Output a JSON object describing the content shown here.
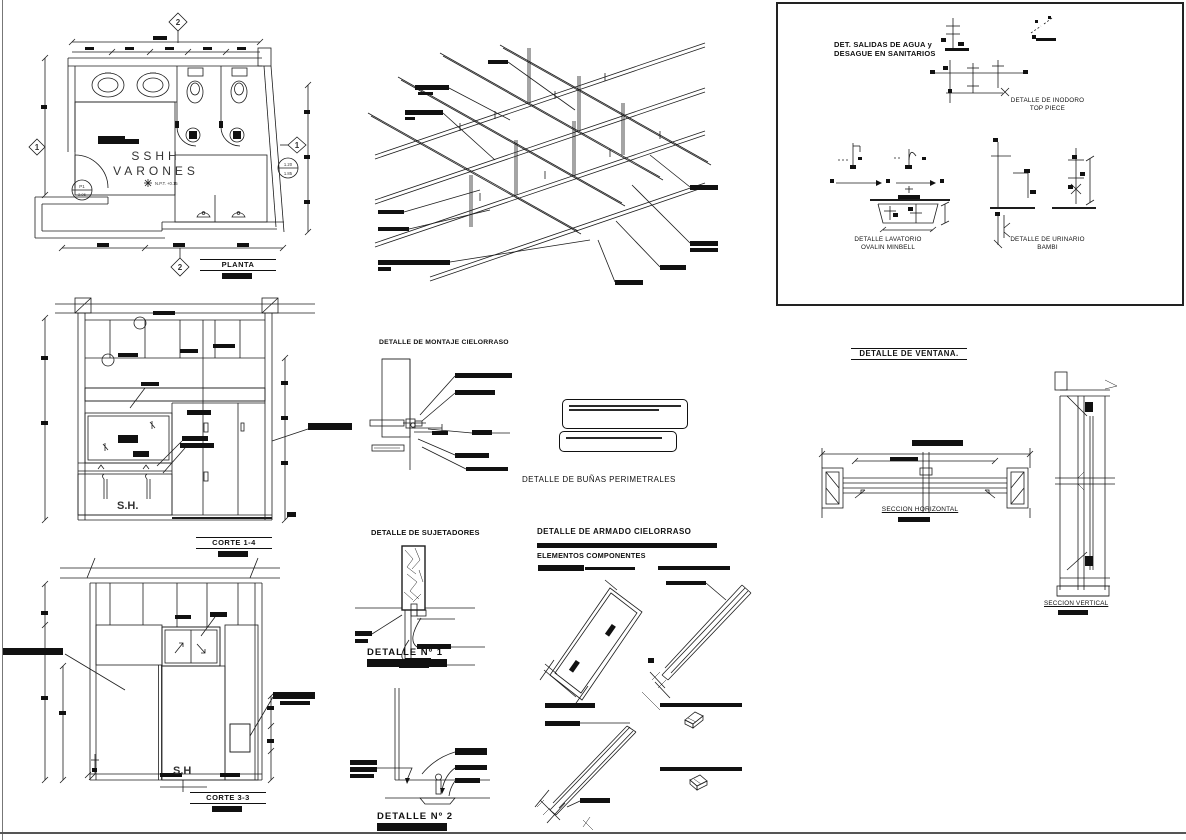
{
  "plan": {
    "title": "PLANTA",
    "room_line1": "SSHH",
    "room_line2": "VARONES",
    "npt_label": "N.P.T. +0.15",
    "door_tag": "P1",
    "door_tag_value": "2.05",
    "axis_top": "2",
    "axis_bottom": "2",
    "axis_right": "1",
    "axis_left": "1",
    "level_top": "1.20",
    "level_bottom": "1.85"
  },
  "corte14": {
    "title": "CORTE 1-4",
    "room_label": "S.H."
  },
  "corte33": {
    "title": "CORTE 3-3",
    "room_label": "S.H"
  },
  "montaje": {
    "title": "DETALLE DE MONTAJE CIELORRASO"
  },
  "bunas": {
    "title": "DETALLE DE BUÑAS PERIMETRALES"
  },
  "sujetadores": {
    "title": "DETALLE DE SUJETADORES"
  },
  "detalle1": {
    "title": "DETALLE  Nº 1"
  },
  "detalle2": {
    "title": "DETALLE  Nº 2"
  },
  "armado": {
    "title": "DETALLE DE ARMADO CIELORRASO",
    "subtitle": "ELEMENTOS COMPONENTES"
  },
  "sanitarios": {
    "title_line1": "DET. SALIDAS DE AGUA y",
    "title_line2": "DESAGUE EN SANITARIOS",
    "inodoro_line1": "DETALLE DE INODORO",
    "inodoro_line2": "TOP PIECE",
    "lavatorio_line1": "DETALLE LAVATORIO",
    "lavatorio_line2": "OVALIN MINBELL",
    "urinario_line1": "DETALLE DE URINARIO",
    "urinario_line2": "BAMBI"
  },
  "ventana": {
    "title": "DETALLE DE VENTANA.",
    "seccion_horizontal": "SECCION HORIZONTAL",
    "seccion_vertical": "SECCION VERTICAL"
  }
}
